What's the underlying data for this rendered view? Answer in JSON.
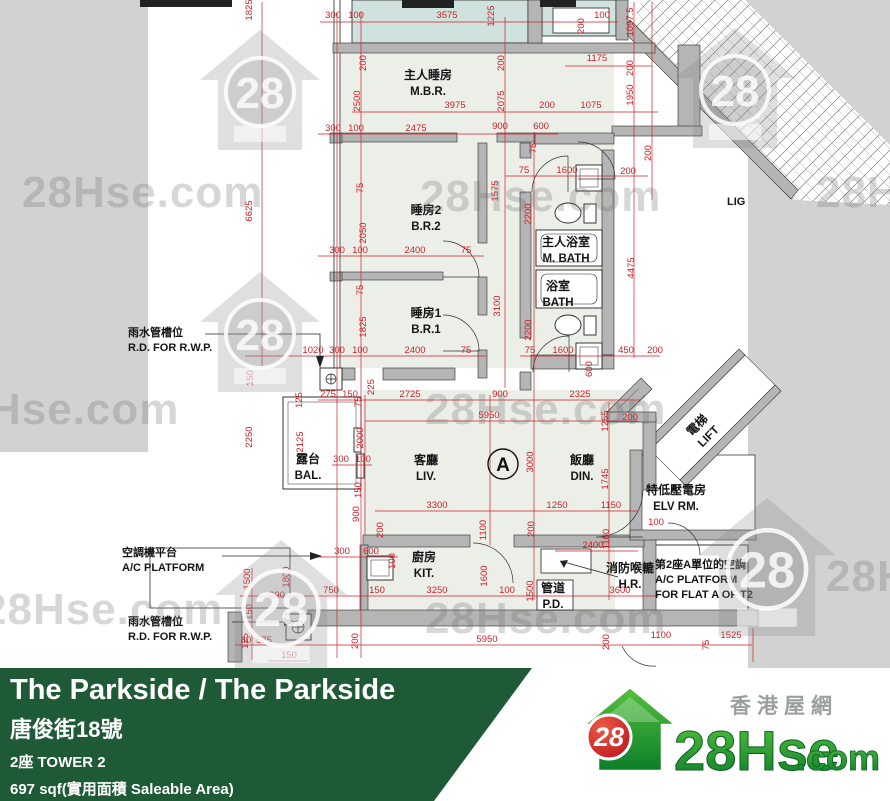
{
  "banner": {
    "title": "The Parkside / The Parkside",
    "address": "唐俊街18號",
    "tower": "2座   TOWER 2",
    "area": "697 sqf(實用面積 Saleable Area)",
    "bg_color": "#1e5a36"
  },
  "logo": {
    "number": "28",
    "site_name": "28Hse",
    "site_tld": ".com",
    "chinese_name": "香港屋網"
  },
  "watermark": {
    "text": "28Hse.com",
    "number": "28"
  },
  "plan": {
    "unit_label": "A",
    "colors": {
      "dimension_red": "#cf2128",
      "wall_grey": "#b5b5b5",
      "outside_grey": "#d2d2d2",
      "room_fill": "#ecefe8",
      "upper_flat_fill": "#cfe2de"
    },
    "rooms": [
      {
        "cn": "主人睡房",
        "en": "M.B.R.",
        "x": 428,
        "y": 79
      },
      {
        "cn": "睡房2",
        "en": "B.R.2",
        "x": 426,
        "y": 214
      },
      {
        "cn": "睡房1",
        "en": "B.R.1",
        "x": 426,
        "y": 317
      },
      {
        "cn": "主人浴室",
        "en": "M. BATH",
        "x": 566,
        "y": 246
      },
      {
        "cn": "浴室",
        "en": "BATH",
        "x": 558,
        "y": 290
      },
      {
        "cn": "客廳",
        "en": "LIV.",
        "x": 426,
        "y": 464
      },
      {
        "cn": "飯廳",
        "en": "DIN.",
        "x": 582,
        "y": 464
      },
      {
        "cn": "廚房",
        "en": "KIT.",
        "x": 424,
        "y": 561
      },
      {
        "cn": "露台",
        "en": "BAL.",
        "x": 308,
        "y": 463
      },
      {
        "cn": "管道",
        "en": "P.D.",
        "x": 553,
        "y": 592
      },
      {
        "cn": "特低壓電房",
        "en": "ELV RM.",
        "x": 676,
        "y": 494
      },
      {
        "cn": "消防喉轆",
        "en": "H.R.",
        "x": 630,
        "y": 572
      },
      {
        "cn": "電梯",
        "en": "LIFT",
        "x": 700,
        "y": 428,
        "rot": -45
      }
    ],
    "annotations": [
      {
        "lines": [
          "雨水管槽位",
          "R.D. FOR R.W.P."
        ],
        "x": 128,
        "y": 336
      },
      {
        "lines": [
          "空調機平台",
          "A/C PLATFORM"
        ],
        "x": 122,
        "y": 556
      },
      {
        "lines": [
          "雨水管槽位",
          "R.D. FOR R.W.P."
        ],
        "x": 128,
        "y": 625
      },
      {
        "lines": [
          "第2座A單位的空調",
          "A/C PLATFORM",
          "FOR FLAT A OF T2"
        ],
        "x": 655,
        "y": 568
      },
      {
        "lines": [
          "LIG"
        ],
        "x": 727,
        "y": 205
      }
    ],
    "dims": [
      {
        "t": "300",
        "x": 333,
        "y": 18
      },
      {
        "t": "100",
        "x": 356,
        "y": 18
      },
      {
        "t": "3575",
        "x": 447,
        "y": 18
      },
      {
        "t": "1225",
        "x": 494,
        "y": 16,
        "r": 1
      },
      {
        "t": "200",
        "x": 584,
        "y": 26,
        "r": 1
      },
      {
        "t": "100",
        "x": 602,
        "y": 18
      },
      {
        "t": "1097.5",
        "x": 633,
        "y": 22,
        "r": 1
      },
      {
        "t": "1825",
        "x": 252,
        "y": 10,
        "r": 1
      },
      {
        "t": "6625",
        "x": 252,
        "y": 211,
        "r": 1
      },
      {
        "t": "200",
        "x": 366,
        "y": 63,
        "r": 1
      },
      {
        "t": "200",
        "x": 504,
        "y": 63,
        "r": 1
      },
      {
        "t": "1175",
        "x": 597,
        "y": 61
      },
      {
        "t": "200",
        "x": 633,
        "y": 68,
        "r": 1
      },
      {
        "t": "1950",
        "x": 633,
        "y": 95,
        "r": 1
      },
      {
        "t": "2500",
        "x": 360,
        "y": 101,
        "r": 1
      },
      {
        "t": "3975",
        "x": 455,
        "y": 108
      },
      {
        "t": "2075",
        "x": 504,
        "y": 101,
        "r": 1
      },
      {
        "t": "200",
        "x": 547,
        "y": 108
      },
      {
        "t": "1075",
        "x": 591,
        "y": 108
      },
      {
        "t": "300",
        "x": 333,
        "y": 131
      },
      {
        "t": "100",
        "x": 356,
        "y": 131
      },
      {
        "t": "2475",
        "x": 416,
        "y": 131
      },
      {
        "t": "900",
        "x": 500,
        "y": 129
      },
      {
        "t": "600",
        "x": 541,
        "y": 129
      },
      {
        "t": "75",
        "x": 536,
        "y": 148,
        "r": 1
      },
      {
        "t": "200",
        "x": 651,
        "y": 153,
        "r": 1
      },
      {
        "t": "75",
        "x": 524,
        "y": 173
      },
      {
        "t": "1600",
        "x": 567,
        "y": 173
      },
      {
        "t": "200",
        "x": 628,
        "y": 174
      },
      {
        "t": "75",
        "x": 363,
        "y": 188,
        "r": 1
      },
      {
        "t": "1575",
        "x": 498,
        "y": 191,
        "r": 1
      },
      {
        "t": "2200",
        "x": 531,
        "y": 214,
        "r": 1
      },
      {
        "t": "2050",
        "x": 366,
        "y": 233,
        "r": 1
      },
      {
        "t": "2400",
        "x": 415,
        "y": 253
      },
      {
        "t": "75",
        "x": 466,
        "y": 253
      },
      {
        "t": "300",
        "x": 337,
        "y": 253
      },
      {
        "t": "100",
        "x": 360,
        "y": 253
      },
      {
        "t": "4475",
        "x": 634,
        "y": 268,
        "r": 1
      },
      {
        "t": "75",
        "x": 363,
        "y": 290,
        "r": 1
      },
      {
        "t": "3100",
        "x": 500,
        "y": 306,
        "r": 1
      },
      {
        "t": "1825",
        "x": 366,
        "y": 327,
        "r": 1
      },
      {
        "t": "2200",
        "x": 531,
        "y": 330,
        "r": 1
      },
      {
        "t": "300",
        "x": 337,
        "y": 353
      },
      {
        "t": "100",
        "x": 360,
        "y": 353
      },
      {
        "t": "2400",
        "x": 415,
        "y": 353
      },
      {
        "t": "75",
        "x": 466,
        "y": 353
      },
      {
        "t": "1020",
        "x": 313,
        "y": 353
      },
      {
        "t": "75",
        "x": 530,
        "y": 353
      },
      {
        "t": "1600",
        "x": 563,
        "y": 353
      },
      {
        "t": "450",
        "x": 626,
        "y": 353
      },
      {
        "t": "200",
        "x": 655,
        "y": 353
      },
      {
        "t": "600",
        "x": 592,
        "y": 369,
        "r": 1
      },
      {
        "t": "150",
        "x": 253,
        "y": 378,
        "r": 1
      },
      {
        "t": "125",
        "x": 302,
        "y": 400,
        "r": 1
      },
      {
        "t": "275",
        "x": 328,
        "y": 397
      },
      {
        "t": "150",
        "x": 350,
        "y": 397
      },
      {
        "t": "75",
        "x": 361,
        "y": 402,
        "r": 1
      },
      {
        "t": "225",
        "x": 374,
        "y": 387,
        "r": 1
      },
      {
        "t": "2725",
        "x": 410,
        "y": 397
      },
      {
        "t": "900",
        "x": 500,
        "y": 397
      },
      {
        "t": "2325",
        "x": 580,
        "y": 397
      },
      {
        "t": "5950",
        "x": 489,
        "y": 418
      },
      {
        "t": "1255",
        "x": 608,
        "y": 421,
        "r": 1
      },
      {
        "t": "200",
        "x": 630,
        "y": 420
      },
      {
        "t": "2250",
        "x": 252,
        "y": 437,
        "r": 1
      },
      {
        "t": "2125",
        "x": 303,
        "y": 442,
        "r": 1
      },
      {
        "t": "2000",
        "x": 363,
        "y": 438,
        "r": 1
      },
      {
        "t": "3000",
        "x": 533,
        "y": 462,
        "r": 1
      },
      {
        "t": "1745",
        "x": 608,
        "y": 479,
        "r": 1
      },
      {
        "t": "300",
        "x": 341,
        "y": 462
      },
      {
        "t": "100",
        "x": 363,
        "y": 462
      },
      {
        "t": "150",
        "x": 361,
        "y": 490,
        "r": 1
      },
      {
        "t": "900",
        "x": 359,
        "y": 514,
        "r": 1
      },
      {
        "t": "3300",
        "x": 437,
        "y": 508
      },
      {
        "t": "1250",
        "x": 557,
        "y": 508
      },
      {
        "t": "1150",
        "x": 611,
        "y": 508
      },
      {
        "t": "200",
        "x": 383,
        "y": 530,
        "r": 1
      },
      {
        "t": "1100",
        "x": 486,
        "y": 530,
        "r": 1
      },
      {
        "t": "200",
        "x": 534,
        "y": 529,
        "r": 1
      },
      {
        "t": "100",
        "x": 656,
        "y": 525
      },
      {
        "t": "2400",
        "x": 593,
        "y": 548
      },
      {
        "t": "1100",
        "x": 609,
        "y": 539,
        "r": 1
      },
      {
        "t": "300",
        "x": 342,
        "y": 554
      },
      {
        "t": "600",
        "x": 371,
        "y": 554
      },
      {
        "t": "100",
        "x": 395,
        "y": 561,
        "r": 1
      },
      {
        "t": "1500",
        "x": 250,
        "y": 579,
        "r": 1
      },
      {
        "t": "1800",
        "x": 289,
        "y": 577,
        "r": 1
      },
      {
        "t": "1600",
        "x": 487,
        "y": 576,
        "r": 1
      },
      {
        "t": "1500",
        "x": 533,
        "y": 591,
        "r": 1
      },
      {
        "t": "150",
        "x": 252,
        "y": 612,
        "r": 1
      },
      {
        "t": "290",
        "x": 277,
        "y": 598
      },
      {
        "t": "750",
        "x": 331,
        "y": 593
      },
      {
        "t": "150",
        "x": 377,
        "y": 593
      },
      {
        "t": "3250",
        "x": 437,
        "y": 593
      },
      {
        "t": "100",
        "x": 507,
        "y": 593
      },
      {
        "t": "3600",
        "x": 620,
        "y": 593
      },
      {
        "t": "125",
        "x": 248,
        "y": 641,
        "r": 1
      },
      {
        "t": "40",
        "x": 246,
        "y": 643
      },
      {
        "t": "575",
        "x": 264,
        "y": 643
      },
      {
        "t": "150",
        "x": 289,
        "y": 658
      },
      {
        "t": "200",
        "x": 358,
        "y": 641,
        "r": 1
      },
      {
        "t": "5950",
        "x": 487,
        "y": 642
      },
      {
        "t": "200",
        "x": 609,
        "y": 642,
        "r": 1
      },
      {
        "t": "1100",
        "x": 661,
        "y": 638
      },
      {
        "t": "75",
        "x": 709,
        "y": 645,
        "r": 1
      },
      {
        "t": "1525",
        "x": 731,
        "y": 638
      }
    ]
  }
}
